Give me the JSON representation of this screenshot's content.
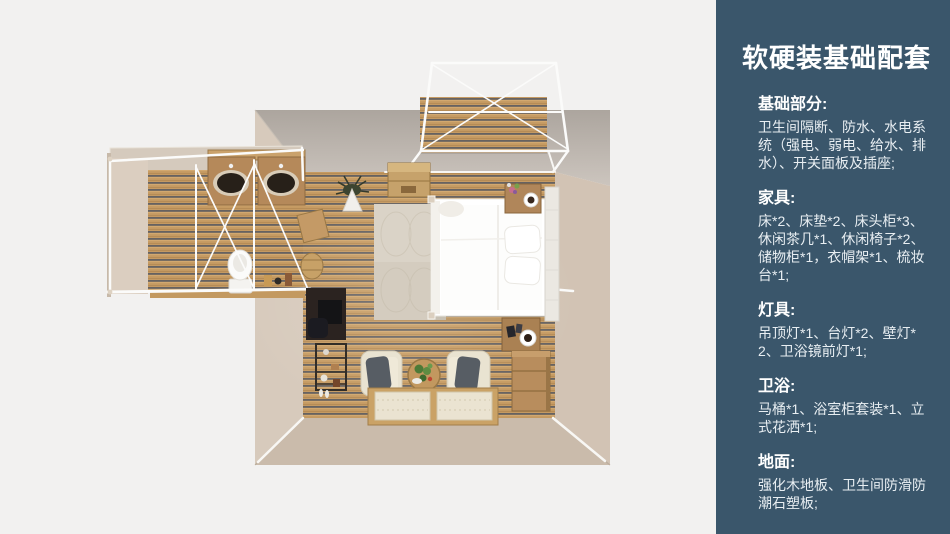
{
  "scene": {
    "background_color": "#f2f1f0",
    "render_type": "top-down 3d floorplan of a bedroom suite with bathroom wing and porch"
  },
  "panel": {
    "bg_color": "#3a566b",
    "title": "软硬装基础配套",
    "title_color": "#ffffff",
    "body_color": "#e8eef2",
    "sections": [
      {
        "heading": "基础部分:",
        "body": "卫生间隔断、防水、水电系统（强电、弱电、给水、排水）、开关面板及插座;"
      },
      {
        "heading": "家具:",
        "body": "床*2、床垫*2、床头柜*3、休闲茶几*1、休闲椅子*2、储物柜*1，衣帽架*1、梳妆台*1;"
      },
      {
        "heading": "灯具:",
        "body": "吊顶灯*1、台灯*2、壁灯*2、卫浴镜前灯*1;"
      },
      {
        "heading": "卫浴:",
        "body": "马桶*1、浴室柜套装*1、立式花洒*1;"
      },
      {
        "heading": "地面:",
        "body": "强化木地板、卫生间防滑防潮石塑板;"
      }
    ]
  },
  "floorplan": {
    "colors": {
      "wood_floor": "#c59a62",
      "wood_gap": "#565860",
      "wall_beige": "#d7cabc",
      "wall_gray": "#b2aba4",
      "frame_white": "#fbfbfa",
      "bed_white": "#ffffff",
      "cushion_gray": "#575d64"
    }
  }
}
